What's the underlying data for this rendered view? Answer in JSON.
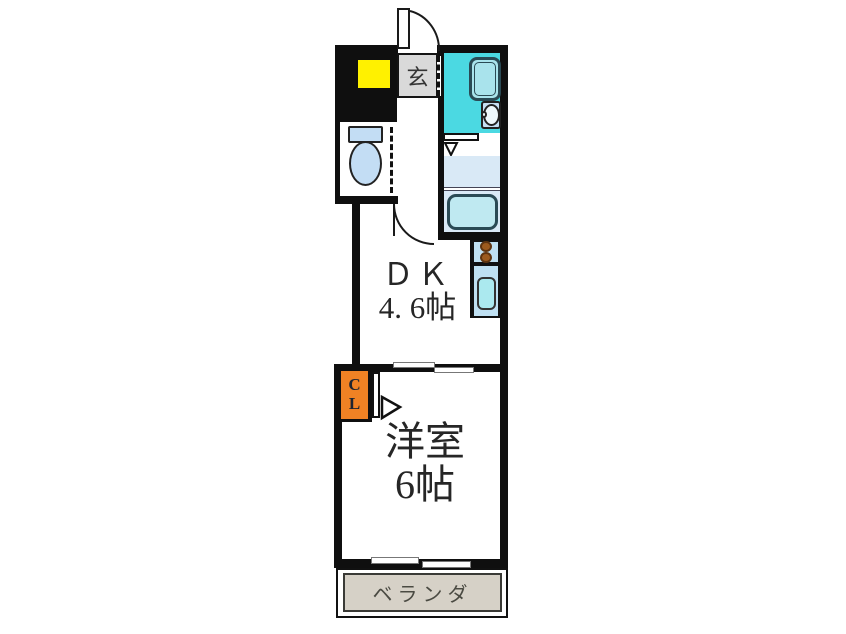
{
  "floor_plan": {
    "title": "apartment-floor-plan-1dk",
    "rooms": {
      "entrance": {
        "label": "玄"
      },
      "dk": {
        "name_line": "ＤＫ",
        "size_line": "4. 6帖"
      },
      "western_room": {
        "name_line": "洋室",
        "size_line": "6帖"
      },
      "closet": {
        "letter_top": "C",
        "letter_bottom": "L"
      },
      "veranda": {
        "label": "ベランダ"
      }
    },
    "fixtures": [
      "entrance-door",
      "unit-bath",
      "bathtub",
      "washbasin",
      "toilet",
      "washing-machine-pan",
      "stove-two-burners",
      "kitchen-sink",
      "sliding-door",
      "windows",
      "closet-door"
    ],
    "colors": {
      "wall": "#0f0f0f",
      "bathroom_floor": "#4bd9e2",
      "fixture_light_blue": "#c3ddf4",
      "fixture_cyan": "#abe9ef",
      "pale_blue_floor": "#d9e9f6",
      "burner_brown": "#9c5a1e",
      "yellow_marker": "#fff100",
      "entrance_gray": "#d9d9d9",
      "closet_orange": "#f08224",
      "veranda_beige": "#d6d1c7",
      "text": "#262626"
    }
  }
}
